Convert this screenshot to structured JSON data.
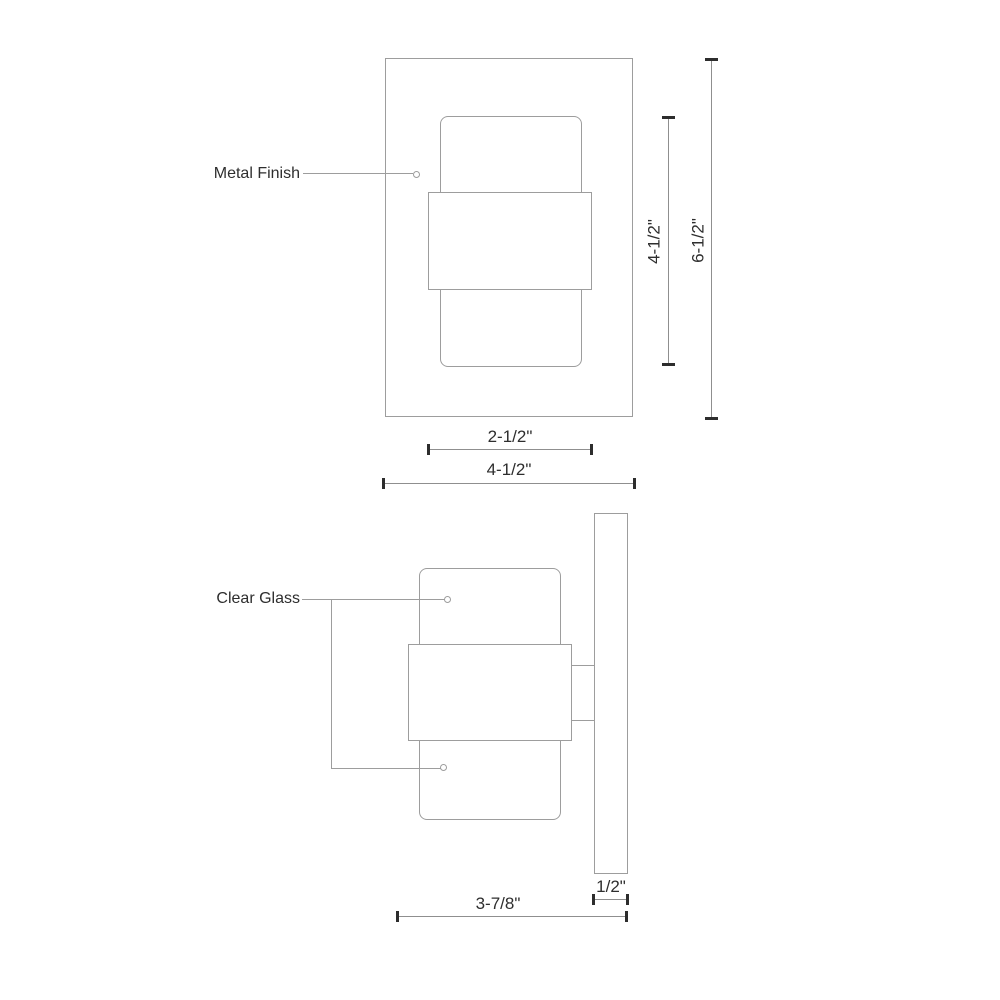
{
  "page": {
    "background": "#ffffff"
  },
  "colors": {
    "outline": "#9d9d9d",
    "dimension_line": "#8f8f8f",
    "tick": "#2d2d2d",
    "text": "#2e2e2e"
  },
  "front_view": {
    "callout": "Metal Finish",
    "dims": {
      "glass_height": "4-1/2\"",
      "overall_height": "6-1/2\"",
      "band_width": "2-1/2\"",
      "overall_width": "4-1/2\""
    }
  },
  "side_view": {
    "callout": "Clear Glass",
    "dims": {
      "backplate_thickness": "1/2\"",
      "extension": "3-7/8\""
    }
  }
}
